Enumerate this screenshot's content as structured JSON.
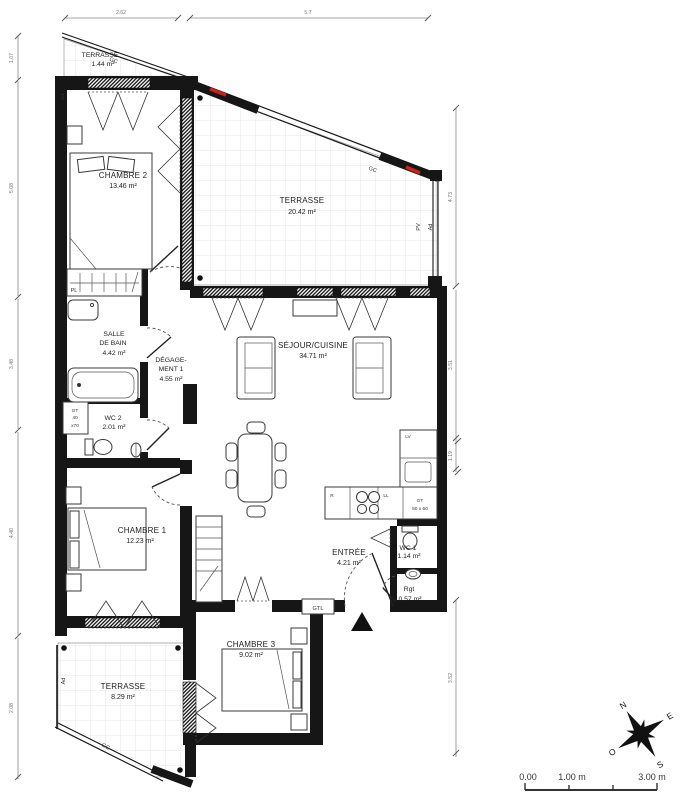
{
  "plan": {
    "title": "apartment-floor-plan",
    "rooms": [
      {
        "id": "terrasse-nw",
        "lines": [
          "TERRASSE",
          "1.44 m²"
        ]
      },
      {
        "id": "chambre-2",
        "lines": [
          "CHAMBRE 2",
          "13.46 m²"
        ]
      },
      {
        "id": "terrasse-main",
        "lines": [
          "TERRASSE",
          "20.42 m²"
        ]
      },
      {
        "id": "salle-de-bain",
        "lines": [
          "SALLE",
          "DE BAIN",
          "4.42 m²"
        ]
      },
      {
        "id": "degagement-1",
        "lines": [
          "DÉGAGE-",
          "MENT 1",
          "4.55 m²"
        ]
      },
      {
        "id": "wc-2",
        "lines": [
          "WC 2",
          "2.01 m²"
        ]
      },
      {
        "id": "sejour-cuisine",
        "lines": [
          "SÉJOUR/CUISINE",
          "34.71 m²"
        ]
      },
      {
        "id": "chambre-1",
        "lines": [
          "CHAMBRE 1",
          "12.23 m²"
        ]
      },
      {
        "id": "entree",
        "lines": [
          "ENTRÉE",
          "4.21 m²"
        ]
      },
      {
        "id": "wc-1",
        "lines": [
          "WC 1",
          "1.14 m²"
        ]
      },
      {
        "id": "rangement",
        "lines": [
          "Rgt",
          "0.57 m²"
        ]
      },
      {
        "id": "chambre-3",
        "lines": [
          "CHAMBRE 3",
          "9.02 m²"
        ]
      },
      {
        "id": "terrasse-sw",
        "lines": [
          "TERRASSE",
          "8.29 m²"
        ]
      }
    ],
    "tech_labels": {
      "gc_small": "GC",
      "gc_main": "GC",
      "gc_sw": "GC",
      "pv": "PV",
      "ad_main": "Ad",
      "ad_c2": "Ad",
      "ad_sw": "Ad",
      "pl": "PL",
      "gtl": "GTL",
      "lv": "LV",
      "fridge": "R",
      "ll": "LL",
      "gt_wc": [
        "GT",
        "40",
        "x70"
      ],
      "gt_kitchen": [
        "GT",
        "50 x 60"
      ]
    },
    "dimensions": {
      "top": [
        "2.62",
        "5.7"
      ],
      "left": [
        "1.07",
        "5.08",
        "3.48",
        "4.40",
        "2.08"
      ],
      "right": [
        "4.73",
        "3.51",
        "1.19",
        "3.52"
      ]
    },
    "compass": {
      "north": "N",
      "east": "E",
      "south": "S",
      "west": "O"
    },
    "scale_bar": {
      "labels": [
        "0.00",
        "1.00 m",
        "3.00 m"
      ]
    },
    "colors": {
      "wall": "#161616",
      "accent_red": "#c9211e",
      "dim_text": "#777777",
      "tile_grid": "#dcdcdc"
    }
  }
}
